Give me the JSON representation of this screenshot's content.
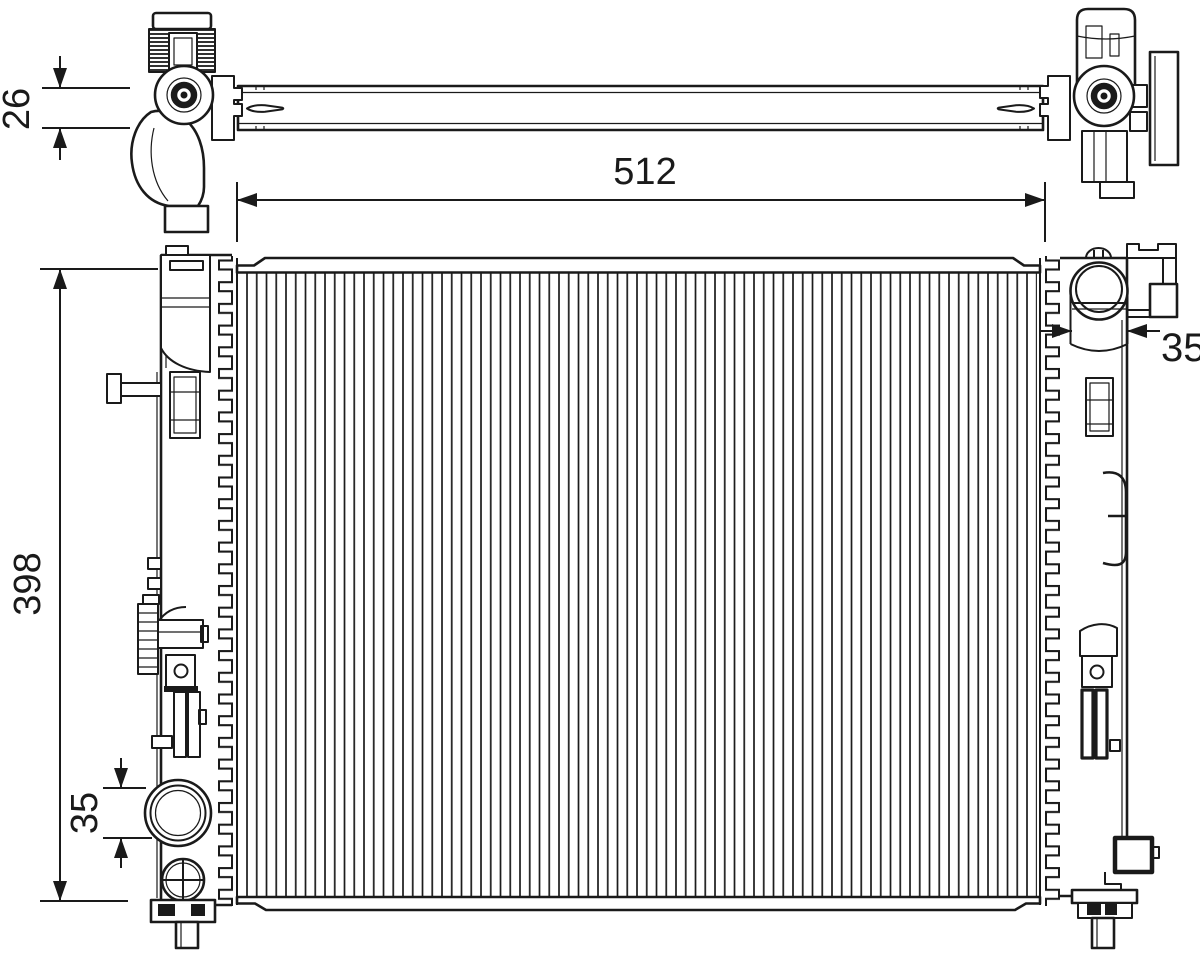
{
  "colors": {
    "line": "#1a1a1a",
    "background": "#ffffff"
  },
  "dimensions": {
    "top_thickness": "26",
    "core_width": "512",
    "core_height": "398",
    "inlet_spacing": "35",
    "filler_neck_width": "35"
  }
}
